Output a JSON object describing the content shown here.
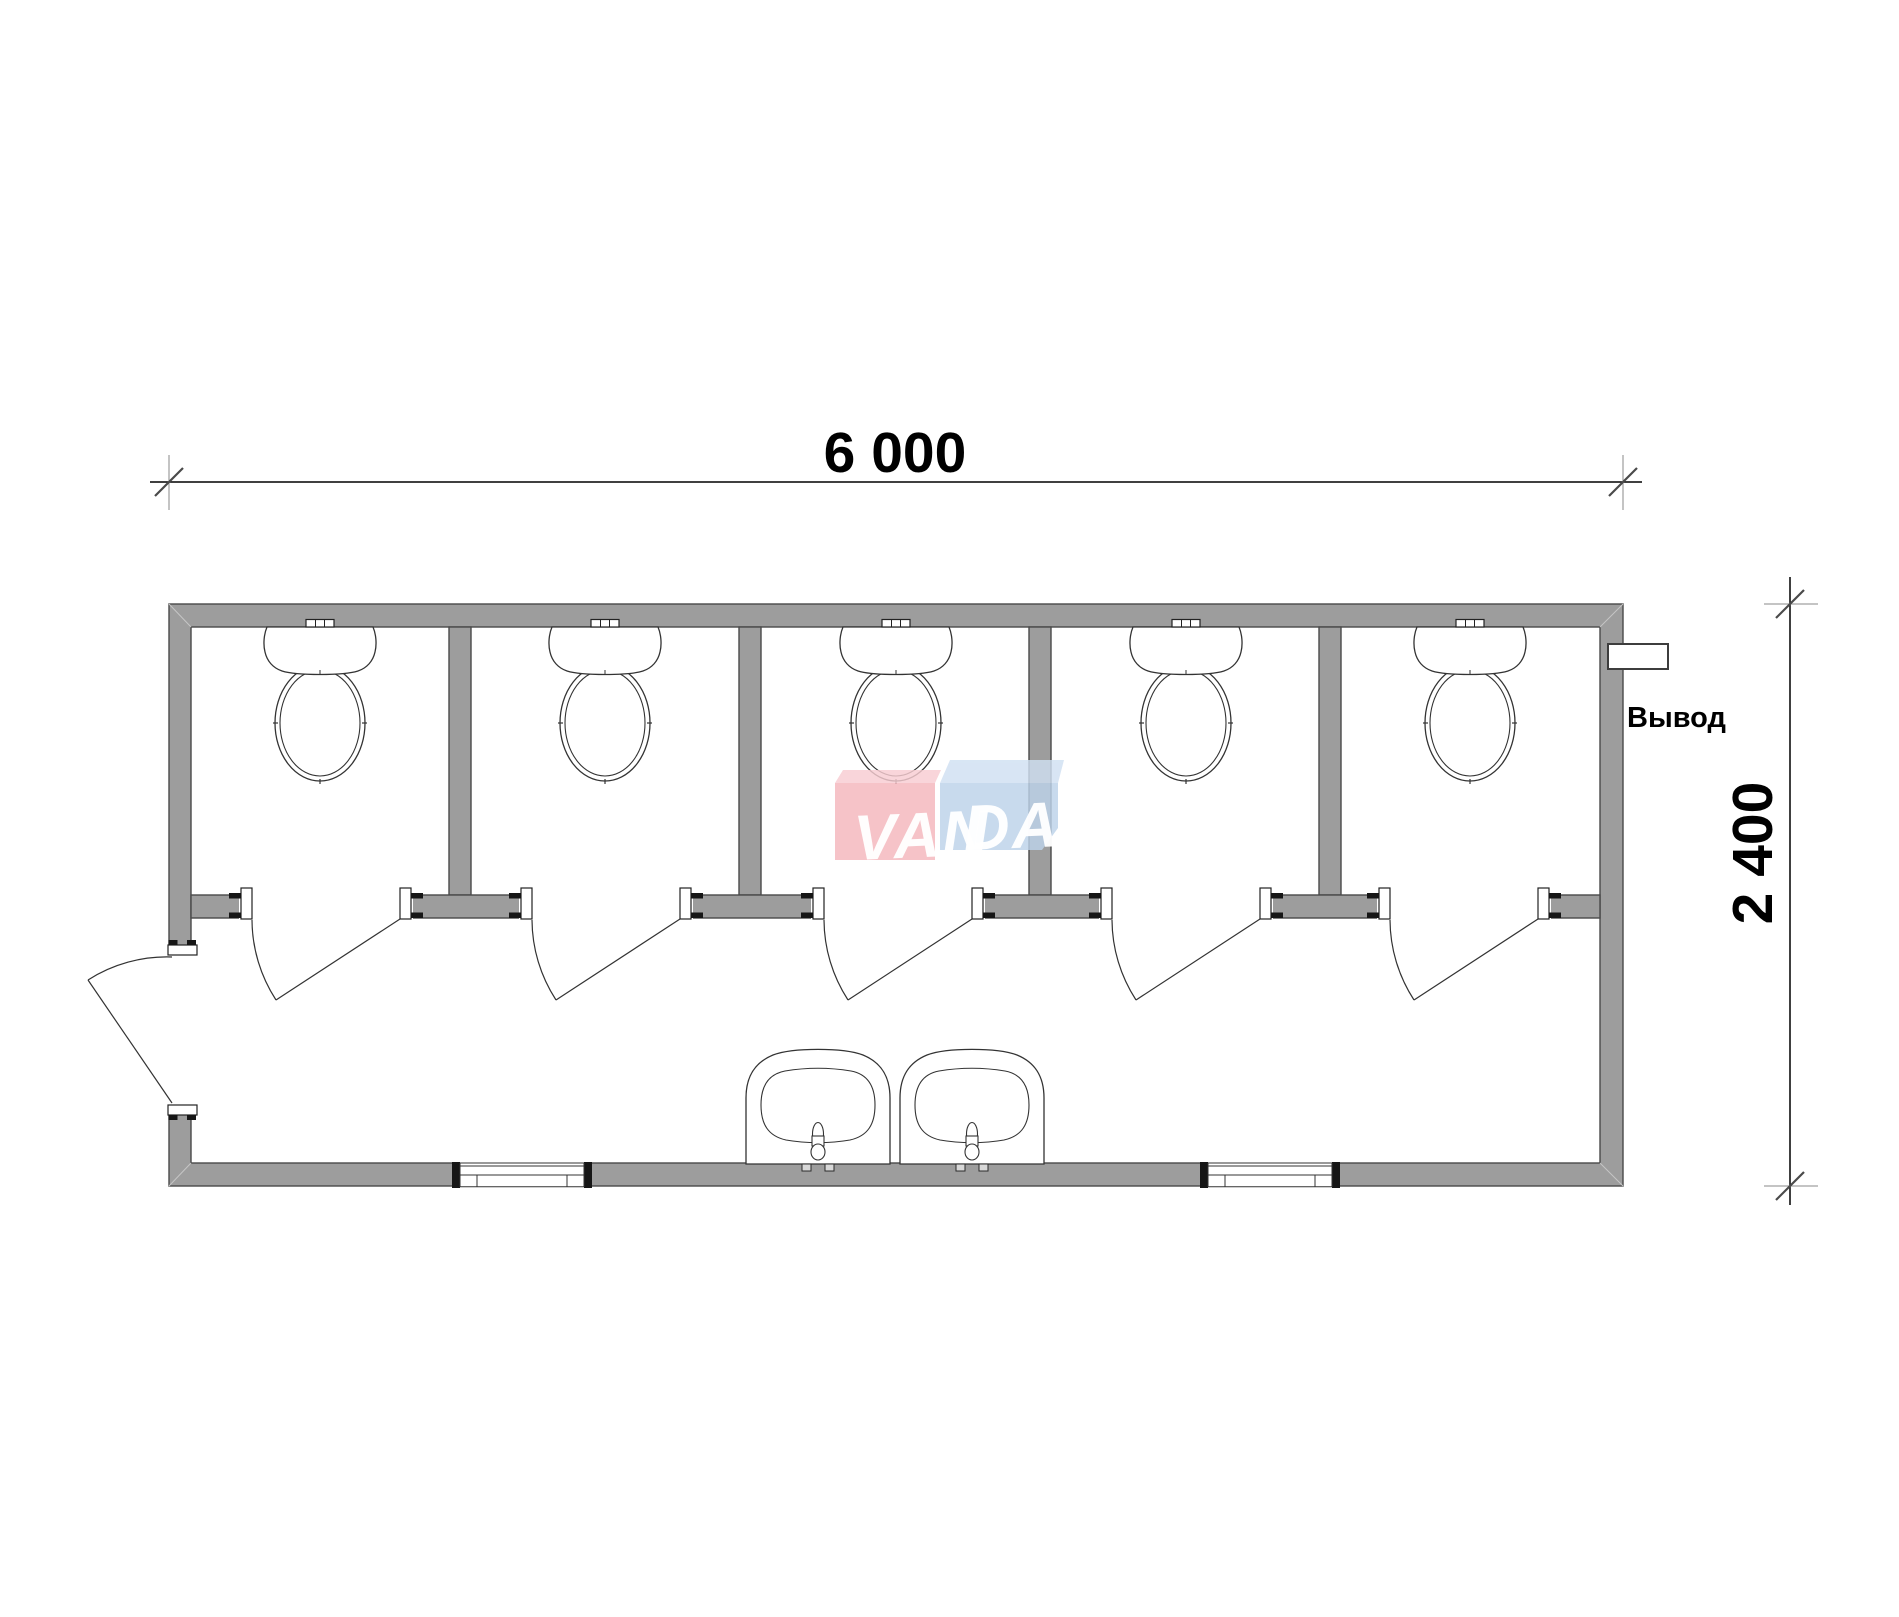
{
  "drawing": {
    "type": "floor-plan",
    "dimensions": {
      "width_label": "6 000",
      "height_label": "2 400"
    },
    "outlet": {
      "label": "Вывод"
    },
    "watermark": {
      "left": "VAN",
      "right": "DA",
      "full": "VANDA"
    },
    "counts": {
      "toilet_stalls": 5,
      "toilets": 5,
      "sinks": 2,
      "windows": 2,
      "stall_doors": 5,
      "entrance_doors": 1
    },
    "colors": {
      "wall_fill": "#9d9d9d",
      "wall_outline": "#4a4a4a",
      "line": "#333333",
      "watermark_pink": "#f5b6bd",
      "watermark_pink_top": "#f8cdd2",
      "watermark_blue": "#bdd3ea",
      "watermark_blue_top": "#d0e0f2"
    }
  }
}
